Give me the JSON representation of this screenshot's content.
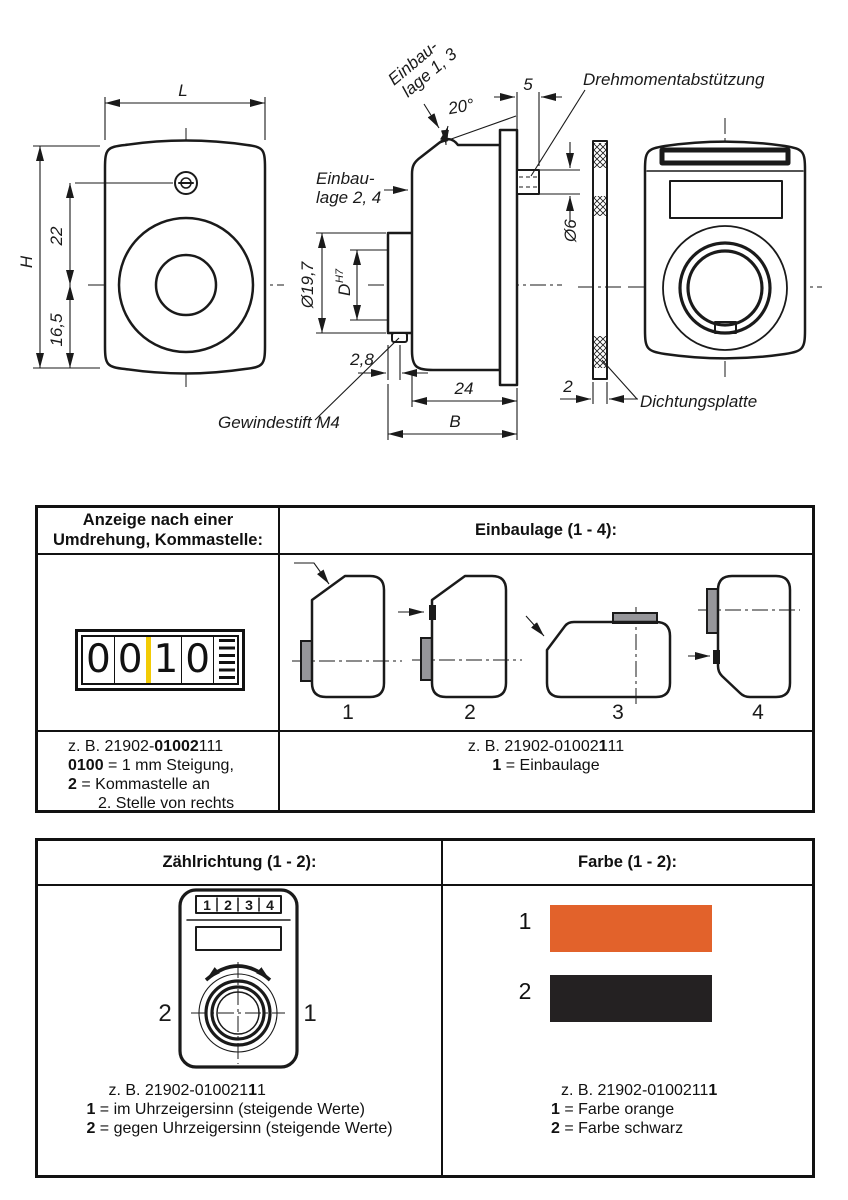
{
  "colors": {
    "orange": "#E2622B",
    "black": "#242122",
    "yellow": "#F2CB05",
    "shape_fill": "#D8D8D9",
    "hub_fill": "#96969A"
  },
  "drawing": {
    "front": {
      "L": "L",
      "H": "H",
      "d22": "22",
      "d165": "16,5"
    },
    "side": {
      "einbau13_l1": "Einbau-",
      "einbau13_l2": "lage 1, 3",
      "einbau24_l1": "Einbau-",
      "einbau24_l2": "lage 2, 4",
      "angle": "20°",
      "d5": "5",
      "dia6": "Ø6",
      "dia197": "Ø19,7",
      "dD": "D",
      "dDsup": "H7",
      "d28": "2,8",
      "d24": "24",
      "B": "B",
      "setscrew_label": "Gewindestift M4"
    },
    "rear": {
      "torque_label": "Drehmomentabstützung",
      "seal_label": "Dichtungsplatte",
      "d2": "2"
    }
  },
  "table1": {
    "header_left_l1": "Anzeige nach einer",
    "header_left_l2": "Umdrehung, Kommastelle:",
    "header_right": "Einbaulage (1 - 4):",
    "counter": {
      "digits": [
        "0",
        "0",
        "1",
        "0"
      ]
    },
    "einbaulage_labels": [
      "1",
      "2",
      "3",
      "4"
    ],
    "foot_left": {
      "ex_prefix": "z. B. 21902-",
      "ex_bold": "01002",
      "ex_suffix": "111",
      "l2_bold": "0100",
      "l2_text": " = 1 mm Steigung,",
      "l3_bold": "2",
      "l3_text": " = Kommastelle an",
      "l4": "2. Stelle von rechts"
    },
    "foot_right": {
      "ex_prefix": "z. B. 21902-01002",
      "ex_bold": "1",
      "ex_suffix": "11",
      "l2_bold": "1",
      "l2_text": " = Einbaulage"
    }
  },
  "table2": {
    "header_left": "Zählrichtung (1 - 2):",
    "header_right": "Farbe (1 - 2):",
    "dial_digits": [
      "1",
      "2",
      "3",
      "4"
    ],
    "dir_left": "2",
    "dir_right": "1",
    "swatch_labels": [
      "1",
      "2"
    ],
    "foot_left": {
      "ex_prefix": "z. B.  21902-010021",
      "ex_bold": "1",
      "ex_suffix": "1",
      "l2_bold": "1",
      "l2_text": " = im Uhrzeigersinn (steigende Werte)",
      "l3_bold": "2",
      "l3_text": " = gegen Uhrzeigersinn (steigende Werte)"
    },
    "foot_right": {
      "ex_prefix": "z. B. 21902-0100211",
      "ex_bold": "1",
      "ex_suffix": "",
      "l2_bold": "1",
      "l2_text": " = Farbe orange",
      "l3_bold": "2",
      "l3_text": " = Farbe schwarz"
    }
  }
}
